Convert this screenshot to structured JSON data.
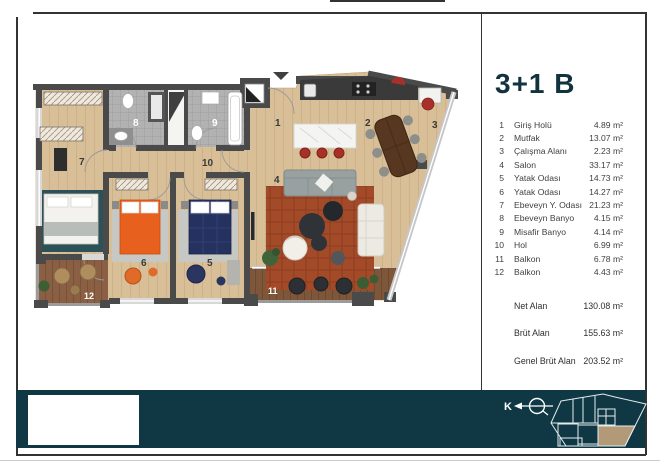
{
  "legend": {
    "title": "3+1 B",
    "rooms": [
      {
        "no": "1",
        "name": "Giriş Holü",
        "area": "4.89 m²"
      },
      {
        "no": "2",
        "name": "Mutfak",
        "area": "13.07 m²"
      },
      {
        "no": "3",
        "name": "Çalışma Alanı",
        "area": "2.23 m²"
      },
      {
        "no": "4",
        "name": "Salon",
        "area": "33.17 m²"
      },
      {
        "no": "5",
        "name": "Yatak Odası",
        "area": "14.73 m²"
      },
      {
        "no": "6",
        "name": "Yatak Odası",
        "area": "14.27 m²"
      },
      {
        "no": "7",
        "name": "Ebeveyn Y. Odası",
        "area": "21.23 m²"
      },
      {
        "no": "8",
        "name": "Ebeveyn Banyo",
        "area": "4.15 m²"
      },
      {
        "no": "9",
        "name": "Misafir Banyo",
        "area": "4.14 m²"
      },
      {
        "no": "10",
        "name": "Hol",
        "area": "6.99 m²"
      },
      {
        "no": "11",
        "name": "Balkon",
        "area": "6.78 m²"
      },
      {
        "no": "12",
        "name": "Balkon",
        "area": "4.43 m²"
      }
    ],
    "totals": [
      {
        "label": "Net Alan",
        "value": "130.08 m²"
      },
      {
        "label": "Brüt Alan",
        "value": "155.63 m²"
      },
      {
        "label": "Genel Brüt Alan",
        "value": "203.52 m²"
      }
    ]
  },
  "footer": {
    "north_label": "K"
  },
  "colors": {
    "accent_teal": "#103844",
    "highlight_unit": "#b29a78",
    "title_color": "#12333e",
    "wall": "#4a4a4a",
    "wood_floor": "#d9bf98",
    "deck": "#7e5639",
    "salon_rug": "#a34b29",
    "master_rug": "#2d5158",
    "orange_bed": "#e8601d",
    "navy_bed": "#25325f",
    "stool_red": "#a83026"
  }
}
